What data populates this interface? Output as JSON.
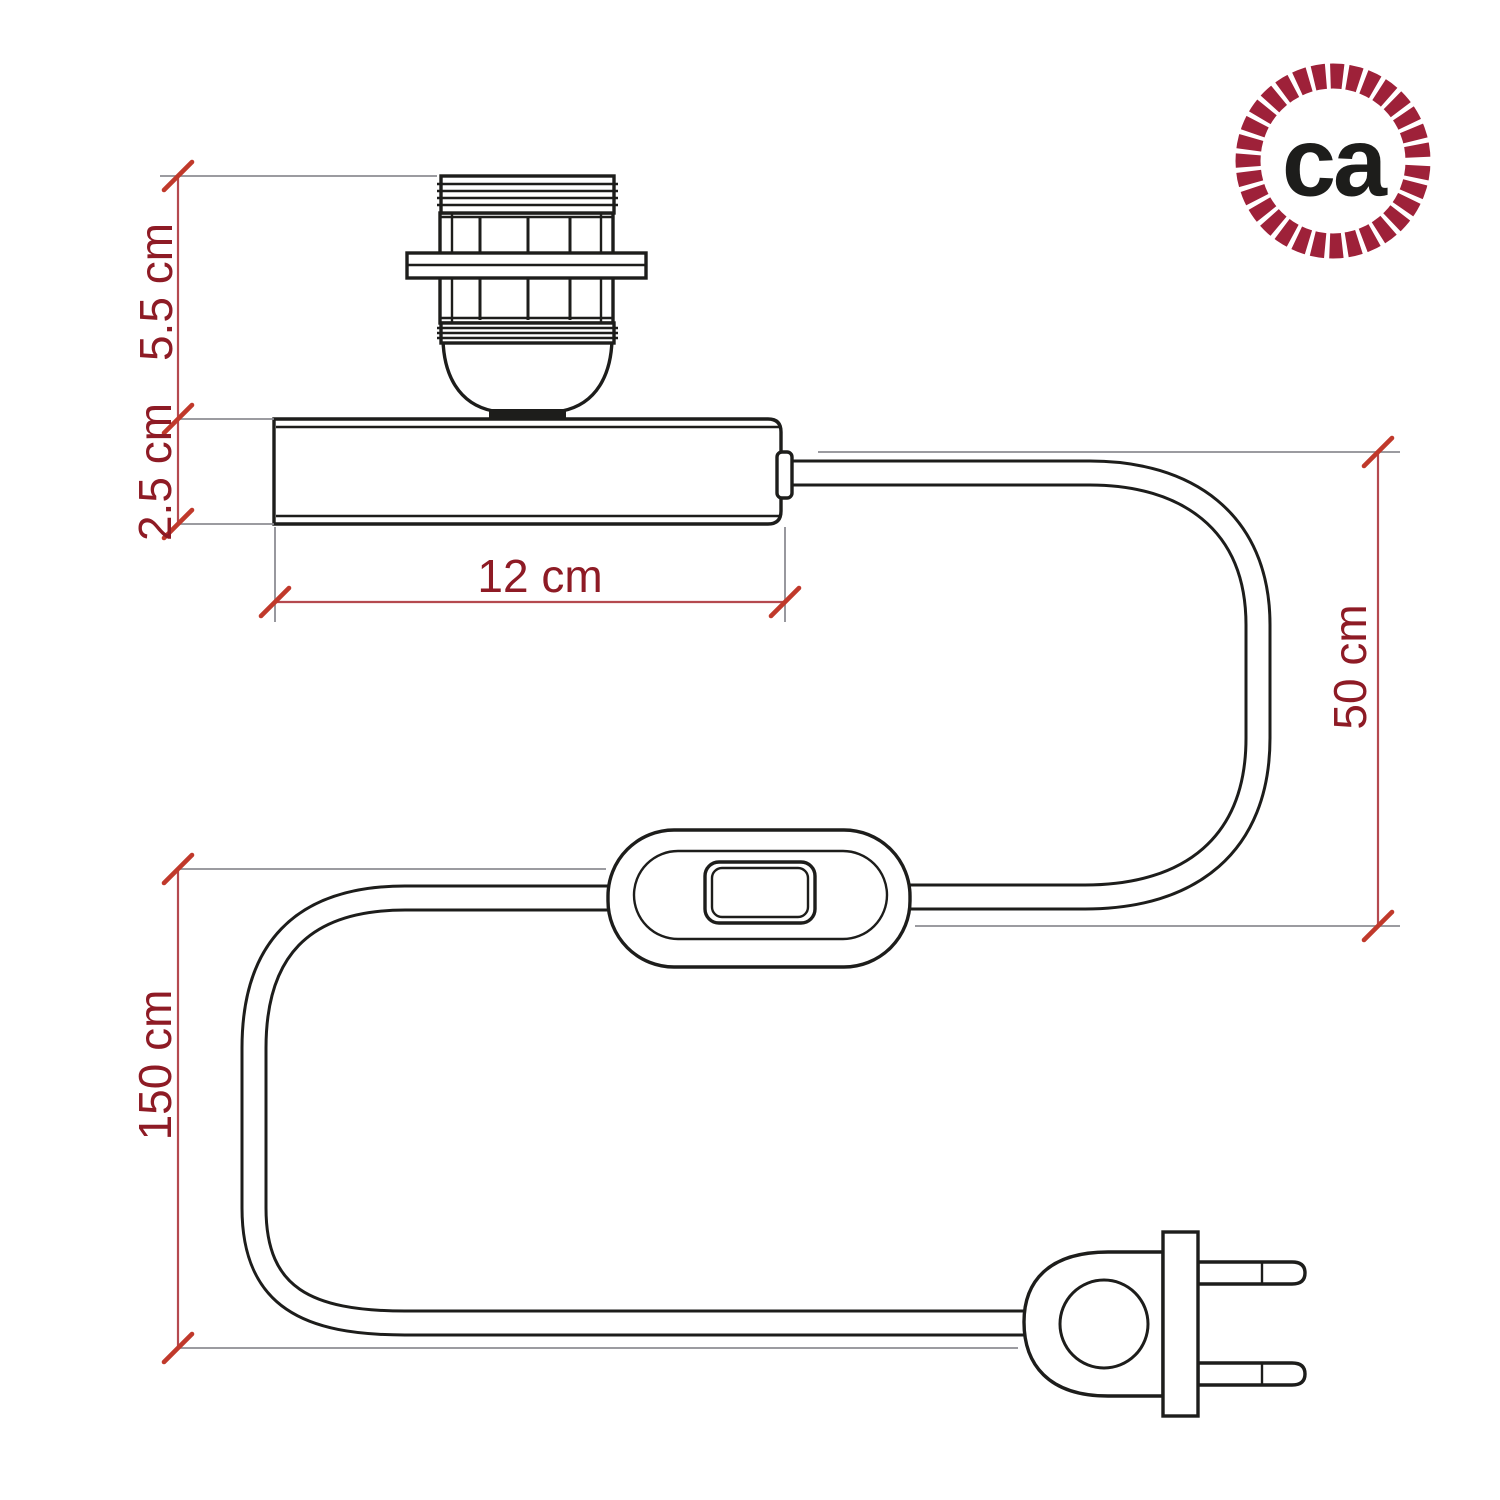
{
  "logo": {
    "text": "ca"
  },
  "dimensions": {
    "socket_height": "5.5 cm",
    "base_height": "2.5 cm",
    "base_width": "12 cm",
    "cable_to_switch": "50 cm",
    "cable_total": "150 cm"
  },
  "colors": {
    "line": "#1d1d1b",
    "dimline": "#b5494f",
    "ext": "#8d8d93",
    "tick": "#c0392b",
    "label": "#8e1b25",
    "brand": "#9e2139",
    "bg": "#ffffff"
  }
}
